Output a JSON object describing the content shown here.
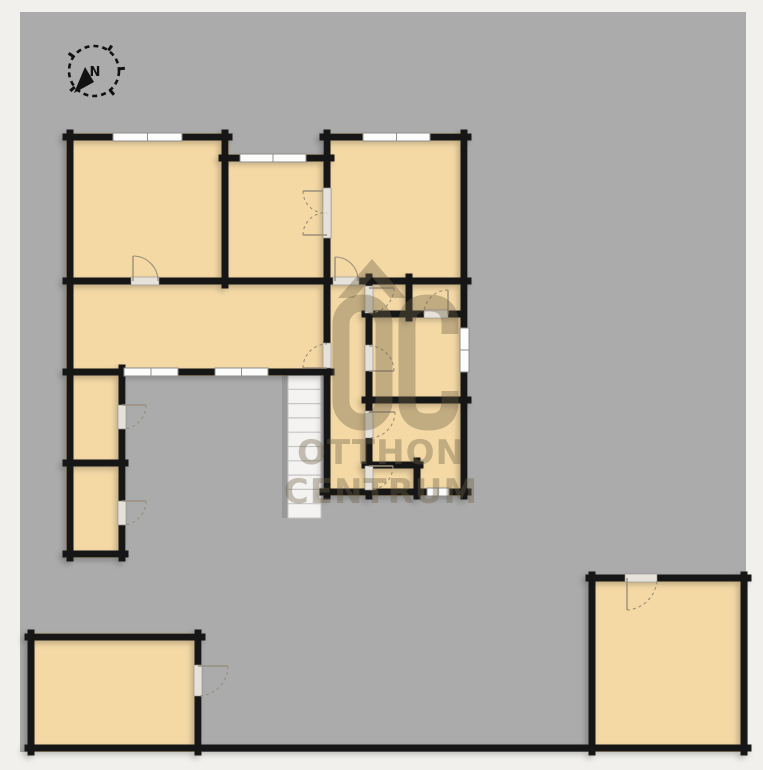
{
  "watermark": {
    "brand_letters": "OC",
    "line1": "OTTHON",
    "line2": "CENTRUM"
  },
  "compass": {
    "label": "N",
    "cx": 94,
    "cy": 71,
    "r": 25,
    "tick_angles": [
      -55,
      -5,
      50,
      140,
      215
    ],
    "needle_points": "74,93 94,82 85,67"
  },
  "colors": {
    "outside": "#f1f0ec",
    "canvas": "#ababab",
    "floor": "#f4d9a5",
    "wall": "#181818",
    "window_fill": "#fcfcfa",
    "window_frame": "#8f8f8f",
    "door_gap": "#e6e2da",
    "door_line": "#9a8f7c",
    "stairs_fill": "#f4f3f1",
    "stairs_line": "#c6c5c2",
    "compass": "#111111",
    "watermark": "rgba(110,98,70,0.38)"
  },
  "canvas": {
    "x": 20,
    "y": 12,
    "w": 726,
    "h": 740
  },
  "floorplan": {
    "rooms": [
      {
        "x": 66,
        "y": 133,
        "w": 163,
        "h": 152
      },
      {
        "x": 222,
        "y": 154,
        "w": 109,
        "h": 131
      },
      {
        "x": 323,
        "y": 133,
        "w": 145,
        "h": 152
      },
      {
        "x": 66,
        "y": 277,
        "w": 265,
        "h": 99
      },
      {
        "x": 323,
        "y": 277,
        "w": 145,
        "h": 219
      },
      {
        "x": 66,
        "y": 368,
        "w": 60,
        "h": 190
      },
      {
        "x": 28,
        "y": 633,
        "w": 174,
        "h": 119
      },
      {
        "x": 589,
        "y": 575,
        "w": 159,
        "h": 177
      }
    ],
    "walls": [
      [
        66,
        137,
        229,
        137
      ],
      [
        222,
        158,
        331,
        158
      ],
      [
        323,
        137,
        468,
        137
      ],
      [
        66,
        281,
        468,
        281
      ],
      [
        66,
        372,
        331,
        372
      ],
      [
        365,
        314,
        464,
        314
      ],
      [
        365,
        400,
        468,
        400
      ],
      [
        365,
        465,
        420,
        465
      ],
      [
        323,
        492,
        468,
        492
      ],
      [
        66,
        463,
        125,
        463
      ],
      [
        66,
        554,
        125,
        554
      ],
      [
        28,
        637,
        202,
        637
      ],
      [
        28,
        748,
        748,
        748
      ],
      [
        589,
        578,
        748,
        578
      ],
      [
        70,
        133,
        70,
        558
      ],
      [
        225,
        133,
        225,
        285
      ],
      [
        327,
        133,
        327,
        496
      ],
      [
        369,
        277,
        369,
        496
      ],
      [
        409,
        277,
        409,
        318
      ],
      [
        417,
        461,
        417,
        496
      ],
      [
        464,
        133,
        464,
        496
      ],
      [
        122,
        368,
        122,
        558
      ],
      [
        31,
        633,
        31,
        752
      ],
      [
        198,
        633,
        198,
        752
      ],
      [
        592,
        575,
        592,
        752
      ],
      [
        744,
        575,
        744,
        752
      ]
    ],
    "windows": [
      {
        "x": 113,
        "y": 133,
        "w": 69,
        "h": 8
      },
      {
        "x": 240,
        "y": 154,
        "w": 66,
        "h": 8
      },
      {
        "x": 363,
        "y": 133,
        "w": 67,
        "h": 8
      },
      {
        "x": 124,
        "y": 368,
        "w": 54,
        "h": 8
      },
      {
        "x": 215,
        "y": 368,
        "w": 53,
        "h": 8
      },
      {
        "x": 460,
        "y": 328,
        "w": 9,
        "h": 44
      },
      {
        "x": 427,
        "y": 488,
        "w": 22,
        "h": 8
      }
    ],
    "doors": [
      {
        "gap": [
          131,
          277,
          28,
          8
        ],
        "leaf": [
          133,
          281,
          133,
          256
        ],
        "arc": "M133,256 A25,25 0 0 1 158,281",
        "dashed": false
      },
      {
        "gap": [
          333,
          277,
          26,
          8
        ],
        "leaf": [
          335,
          281,
          335,
          257
        ],
        "arc": "M335,257 A23,23 0 0 1 358,281",
        "dashed": false
      },
      {
        "gap": [
          323,
          188,
          8,
          50
        ],
        "leaf": [
          327,
          191,
          303,
          191
        ],
        "arc": "M303,191 A22,22 0 0 0 327,213",
        "dashed": true
      },
      {
        "gap": [
          323,
          188,
          8,
          50
        ],
        "leaf": [
          327,
          235,
          303,
          235
        ],
        "arc": "M303,235 A22,22 0 0 1 327,213",
        "dashed": true
      },
      {
        "gap": [
          323,
          343,
          8,
          25
        ],
        "leaf": [
          327,
          368,
          303,
          368
        ],
        "arc": "M303,368 A24,24 0 0 1 327,344",
        "dashed": true
      },
      {
        "gap": [
          365,
          286,
          8,
          27
        ],
        "leaf": [
          369,
          288,
          394,
          288
        ],
        "arc": "M394,288 A25,25 0 0 1 369,313",
        "dashed": true
      },
      {
        "gap": [
          365,
          345,
          8,
          26
        ],
        "leaf": [
          369,
          371,
          394,
          371
        ],
        "arc": "M394,371 A25,25 0 0 0 369,346",
        "dashed": true
      },
      {
        "gap": [
          365,
          411,
          8,
          27
        ],
        "leaf": [
          369,
          412,
          395,
          412
        ],
        "arc": "M395,412 A26,26 0 0 1 369,438",
        "dashed": true
      },
      {
        "gap": [
          365,
          466,
          8,
          24
        ],
        "leaf": [
          369,
          466,
          393,
          466
        ],
        "arc": "M393,466 A24,24 0 0 1 369,490",
        "dashed": true
      },
      {
        "gap": [
          424,
          310,
          24,
          8
        ],
        "leaf": [
          448,
          314,
          448,
          290
        ],
        "arc": "M448,290 A24,24 0 0 0 424,314",
        "dashed": true
      },
      {
        "gap": [
          118,
          405,
          8,
          24
        ],
        "leaf": [
          122,
          405,
          146,
          405
        ],
        "arc": "M146,405 A24,24 0 0 1 122,429",
        "dashed": true
      },
      {
        "gap": [
          118,
          501,
          8,
          24
        ],
        "leaf": [
          122,
          501,
          146,
          501
        ],
        "arc": "M146,501 A24,24 0 0 1 122,525",
        "dashed": true
      },
      {
        "gap": [
          194,
          665,
          8,
          31
        ],
        "leaf": [
          198,
          666,
          228,
          666
        ],
        "arc": "M228,666 A30,30 0 0 1 198,696",
        "dashed": true
      },
      {
        "gap": [
          625,
          574,
          32,
          8
        ],
        "leaf": [
          627,
          578,
          627,
          610
        ],
        "arc": "M627,610 A32,32 0 0 0 657,578",
        "dashed": true
      }
    ],
    "stairs": {
      "x": 288,
      "y": 375,
      "w": 33,
      "h": 143,
      "steps": 10
    },
    "logo": {
      "roof_path": "M338,298 L372,259 L406,298 L390,298 L372,277 L354,298 Z",
      "o_rect": {
        "x": 341,
        "y": 303,
        "w": 43,
        "h": 119,
        "r": 21
      },
      "c_path": "M450,334 L450,324 Q450,303 429,303 L428,303 Q407,303 407,324 L407,401 Q407,422 428,422 L429,422 Q450,422 450,401 L450,391",
      "stroke_width": 17
    }
  }
}
